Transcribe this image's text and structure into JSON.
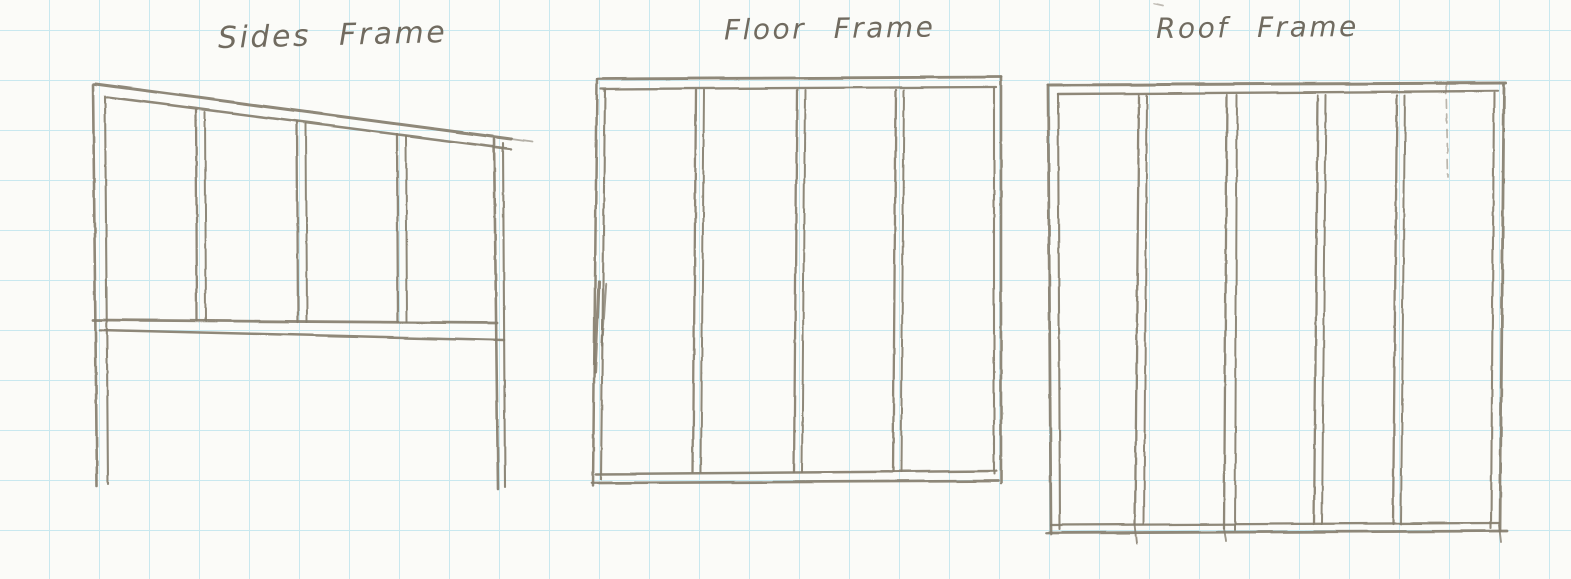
{
  "page": {
    "kind": "hand-drawn pencil sketch on graph paper",
    "paper_color": "#fbfbf8",
    "grid_color": "#c9e8ef",
    "grid_spacing_px": 50,
    "pencil_color": "#867e6f",
    "ink_color": "#5f584c"
  },
  "diagrams": [
    {
      "id": "sides-frame",
      "title": "Sides Frame",
      "shape": "wall frame with sloped top plate, 5 studs, horizontal rail, legs extending below rail",
      "strokes": [
        [
          93,
          84,
          97,
          486,
          2.6
        ],
        [
          105,
          96,
          108,
          484,
          2.1
        ],
        [
          95,
          84,
          511,
          139,
          3.0
        ],
        [
          107,
          97,
          511,
          149,
          2.5
        ],
        [
          511,
          139,
          532,
          142,
          1.8,
          0.6
        ],
        [
          196,
          110,
          197,
          321,
          2.3
        ],
        [
          205,
          112,
          206,
          321,
          2.0
        ],
        [
          297,
          122,
          298,
          322,
          2.3
        ],
        [
          306,
          124,
          307,
          322,
          2.0
        ],
        [
          397,
          134,
          398,
          322,
          2.3
        ],
        [
          406,
          136,
          407,
          322,
          2.0
        ],
        [
          494,
          139,
          498,
          489,
          2.6
        ],
        [
          503,
          143,
          505,
          487,
          2.1
        ],
        [
          93,
          320,
          497,
          323,
          2.8
        ],
        [
          100,
          330,
          504,
          340,
          2.5
        ]
      ]
    },
    {
      "id": "floor-frame",
      "title": "Floor Frame",
      "shape": "rectangular frame with double-line rim and 3 interior joists",
      "strokes": [
        [
          598,
          79,
          1001,
          77,
          2.8
        ],
        [
          601,
          89,
          996,
          87,
          2.3
        ],
        [
          597,
          79,
          593,
          486,
          2.5
        ],
        [
          605,
          90,
          601,
          479,
          2.1
        ],
        [
          599,
          282,
          595,
          372,
          3.2,
          0.9
        ],
        [
          606,
          284,
          602,
          345,
          2.4,
          0.8
        ],
        [
          596,
          474,
          996,
          471,
          2.5
        ],
        [
          592,
          483,
          998,
          481,
          2.7
        ],
        [
          1001,
          77,
          1001,
          483,
          2.6
        ],
        [
          994,
          88,
          994,
          474,
          2.1
        ],
        [
          696,
          90,
          693,
          472,
          2.3
        ],
        [
          704,
          90,
          701,
          472,
          2.0
        ],
        [
          797,
          90,
          794,
          472,
          2.3
        ],
        [
          805,
          90,
          802,
          472,
          2.0
        ],
        [
          896,
          90,
          893,
          472,
          2.3
        ],
        [
          904,
          90,
          901,
          472,
          2.0
        ]
      ]
    },
    {
      "id": "roof-frame",
      "title": "Roof Frame",
      "shape": "rectangular frame with double-line rim and 4 interior rafters, faint dashed guide line near right side",
      "strokes": [
        [
          1048,
          85,
          1506,
          83,
          3.0
        ],
        [
          1058,
          94,
          1498,
          91,
          2.4
        ],
        [
          1048,
          85,
          1051,
          534,
          2.8
        ],
        [
          1058,
          94,
          1060,
          529,
          2.1
        ],
        [
          1051,
          525,
          1499,
          523,
          2.3
        ],
        [
          1046,
          533,
          1507,
          531,
          2.8
        ],
        [
          1499,
          525,
          1501,
          542,
          1.9,
          0.8
        ],
        [
          1504,
          85,
          1500,
          531,
          2.8
        ],
        [
          1494,
          93,
          1491,
          528,
          2.1
        ],
        [
          1139,
          95,
          1135,
          524,
          2.3
        ],
        [
          1147,
          95,
          1144,
          524,
          2.0
        ],
        [
          1135,
          524,
          1137,
          543,
          1.9,
          0.85
        ],
        [
          1227,
          95,
          1224,
          528,
          2.3
        ],
        [
          1237,
          95,
          1235,
          530,
          2.0
        ],
        [
          1224,
          528,
          1226,
          541,
          1.9,
          0.8
        ],
        [
          1318,
          95,
          1314,
          524,
          2.3
        ],
        [
          1326,
          95,
          1322,
          524,
          2.0
        ],
        [
          1397,
          95,
          1393,
          524,
          2.3
        ],
        [
          1405,
          95,
          1401,
          524,
          2.0
        ],
        [
          1446,
          84,
          1448,
          177,
          1.7,
          0.55,
          "9 6"
        ],
        [
          1154,
          4,
          1163,
          6,
          1.8,
          0.5
        ]
      ]
    }
  ]
}
